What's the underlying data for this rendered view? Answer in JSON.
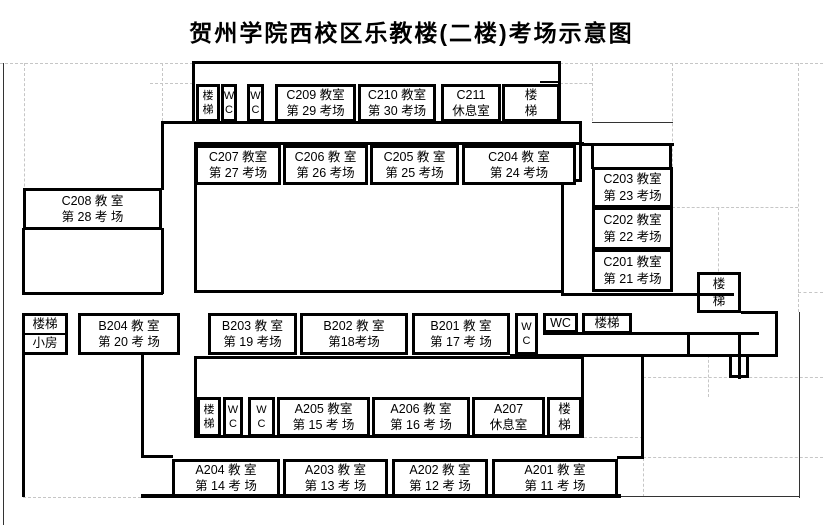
{
  "title": "贺州学院西校区乐教楼(二楼)考场示意图",
  "colors": {
    "wall": "#000000",
    "gridline": "#c6c6c6",
    "background": "#ffffff",
    "text": "#000000"
  },
  "floor_plan": {
    "rooms": [
      {
        "id": "nw_stairs",
        "lines": [
          "楼",
          "梯"
        ]
      },
      {
        "id": "nw_wc1",
        "lines": [
          "W",
          "C"
        ]
      },
      {
        "id": "nw_wc2",
        "lines": [
          "W",
          "C"
        ]
      },
      {
        "id": "C209",
        "lines": [
          "C209 教室",
          "第 29 考场"
        ]
      },
      {
        "id": "C210",
        "lines": [
          "C210 教室",
          "第 30 考场"
        ]
      },
      {
        "id": "C211",
        "lines": [
          "C211",
          "休息室"
        ]
      },
      {
        "id": "ne_stairs",
        "lines": [
          "楼",
          "梯"
        ]
      },
      {
        "id": "C207",
        "lines": [
          "C207 教室",
          "第 27 考场"
        ]
      },
      {
        "id": "C206",
        "lines": [
          "C206 教 室",
          "第 26 考场"
        ]
      },
      {
        "id": "C205",
        "lines": [
          "C205 教 室",
          "第 25 考场"
        ]
      },
      {
        "id": "C204",
        "lines": [
          "C204 教 室",
          "第 24 考场"
        ]
      },
      {
        "id": "C208",
        "lines": [
          "C208 教 室",
          "第 28 考 场"
        ]
      },
      {
        "id": "C203",
        "lines": [
          "C203 教室",
          "第 23 考场"
        ]
      },
      {
        "id": "C202",
        "lines": [
          "C202 教室",
          "第 22 考场"
        ]
      },
      {
        "id": "C201",
        "lines": [
          "C201 教室",
          "第 21 考场"
        ]
      },
      {
        "id": "e_stairs",
        "lines": [
          "楼",
          "梯"
        ]
      },
      {
        "id": "w_split",
        "kind": "split",
        "lines": [
          "楼梯",
          "小房"
        ]
      },
      {
        "id": "B204",
        "lines": [
          "B204 教 室",
          "第 20 考 场"
        ]
      },
      {
        "id": "B203",
        "lines": [
          "B203 教 室",
          "第 19 考场"
        ]
      },
      {
        "id": "B202",
        "lines": [
          "B202 教 室",
          "第18考场"
        ]
      },
      {
        "id": "B201",
        "lines": [
          "B201 教 室",
          "第 17 考 场"
        ]
      },
      {
        "id": "mid_wc_tall",
        "lines": [
          "W",
          "C"
        ]
      },
      {
        "id": "mid_wc",
        "lines": [
          "WC"
        ]
      },
      {
        "id": "mid_stairs",
        "lines": [
          "楼梯"
        ]
      },
      {
        "id": "sw_stairs",
        "lines": [
          "楼",
          "梯"
        ]
      },
      {
        "id": "sw_wc1",
        "lines": [
          "W",
          "C"
        ]
      },
      {
        "id": "sw_wc2",
        "lines": [
          "W",
          "C"
        ]
      },
      {
        "id": "A205",
        "lines": [
          "A205 教室",
          "第 15 考 场"
        ]
      },
      {
        "id": "A206",
        "lines": [
          "A206 教 室",
          "第 16 考 场"
        ]
      },
      {
        "id": "A207",
        "lines": [
          "A207",
          "休息室"
        ]
      },
      {
        "id": "se_stairs",
        "lines": [
          "楼",
          "梯"
        ]
      },
      {
        "id": "A204",
        "lines": [
          "A204 教 室",
          "第 14 考 场"
        ]
      },
      {
        "id": "A203",
        "lines": [
          "A203 教 室",
          "第 13 考 场"
        ]
      },
      {
        "id": "A202",
        "lines": [
          "A202 教 室",
          "第 12 考 场"
        ]
      },
      {
        "id": "A201",
        "lines": [
          "A201 教 室",
          "第 11 考 场"
        ]
      }
    ]
  }
}
